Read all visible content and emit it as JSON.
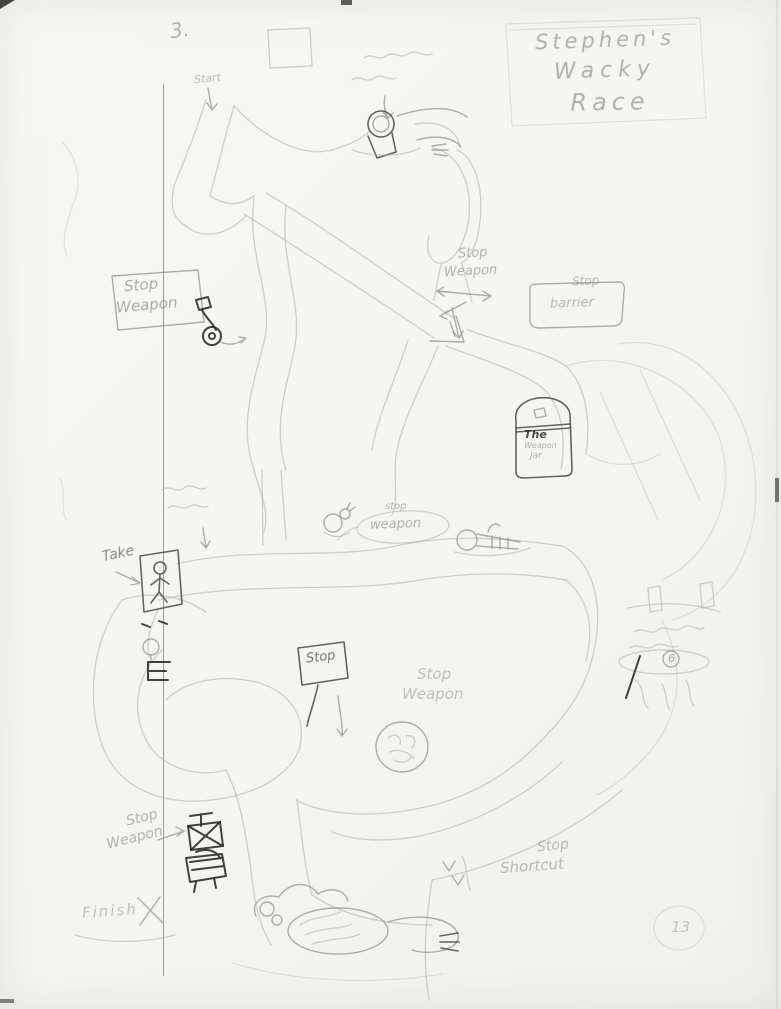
{
  "palette": {
    "paper": "#f5f5f2",
    "pencil_faint": "#b3b3ac",
    "pencil_mid": "#8e8e87",
    "pencil_dark": "#4a4a45",
    "graphite_black": "#2d2d2a"
  },
  "header": {
    "corner_number": "3.",
    "title": {
      "line1": "Stephen's",
      "line2": "Wacky",
      "line3": "Race"
    }
  },
  "annotations": {
    "start": "Start",
    "stop_weapon_left": {
      "line1": "Stop",
      "line2": "Weapon"
    },
    "stop_weapon_top": {
      "line1": "Stop",
      "line2": "Weapon"
    },
    "stop_barrier": {
      "line1": "Stop",
      "line2": "barrier"
    },
    "weapon_jar": {
      "line1": "The",
      "line2": "Weapon",
      "line3": "Jar"
    },
    "stop_weapon_bubble": {
      "line1": "stop",
      "line2": "weapon"
    },
    "take": "Take",
    "stop_sign": "Stop",
    "stop_weapon_mid": {
      "line1": "Stop",
      "line2": "Weapon"
    },
    "stop_weapon_bottom": {
      "line1": "Stop",
      "line2": "Weapon"
    },
    "stop_shortcut": {
      "line1": "Stop",
      "line2": "Shortcut"
    },
    "finish": "Finish",
    "podium_number": "6",
    "page_number": "13"
  }
}
